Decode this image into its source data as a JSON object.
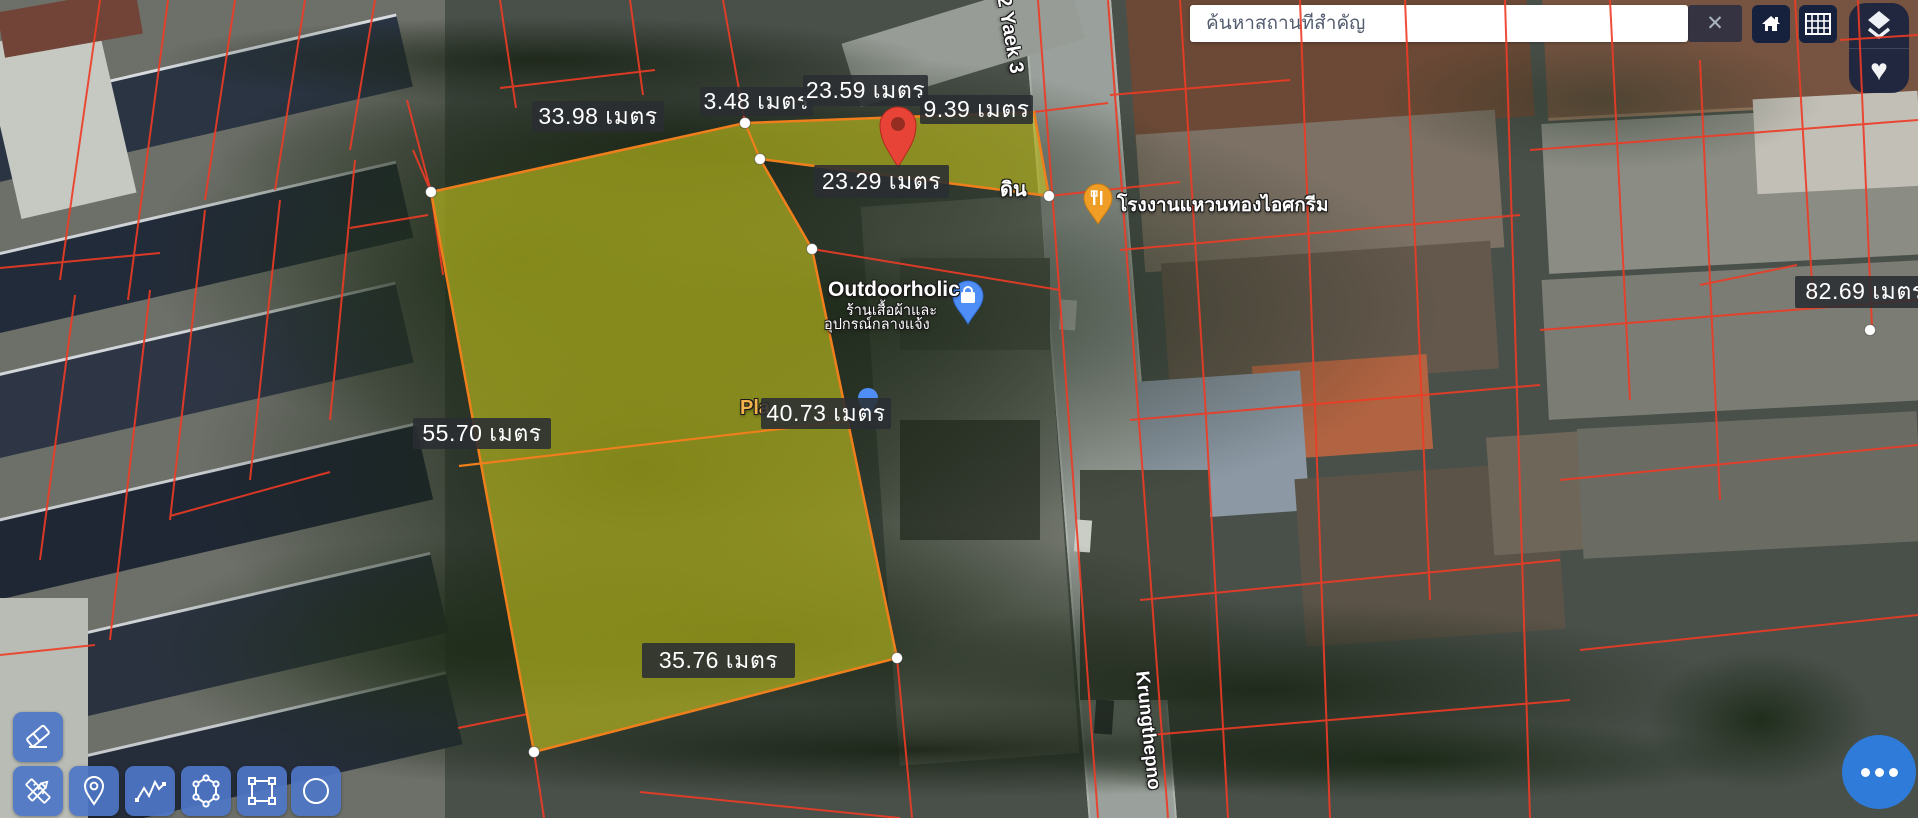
{
  "colors": {
    "parcel_fill": "#e2de1c",
    "parcel_border": "#ef7f1c",
    "cadastral_line": "#ee3b25",
    "tool_blue": "#4d76c7",
    "more_blue": "#2e7bd9",
    "marker_red": "#e74336"
  },
  "search": {
    "placeholder": "ค้นหาสถานที่สำคัญ"
  },
  "controls": {
    "close": "✕",
    "heart": "♥"
  },
  "measurements": [
    {
      "text": "33.98 เมตร",
      "x": 532,
      "y": 101,
      "w": 132,
      "h": 31
    },
    {
      "text": "3.48 เมตร",
      "x": 700,
      "y": 87,
      "w": 113,
      "h": 29
    },
    {
      "text": "23.59 เมตร",
      "x": 803,
      "y": 75,
      "w": 125,
      "h": 31
    },
    {
      "text": "9.39 เมตร",
      "x": 920,
      "y": 95,
      "w": 113,
      "h": 29
    },
    {
      "text": "23.29 เมตร",
      "x": 814,
      "y": 165,
      "w": 135,
      "h": 33
    },
    {
      "text": "55.70 เมตร",
      "x": 413,
      "y": 418,
      "w": 138,
      "h": 31
    },
    {
      "text": "40.73 เมตร",
      "x": 761,
      "y": 398,
      "w": 130,
      "h": 31
    },
    {
      "text": "35.76 เมตร",
      "x": 642,
      "y": 643,
      "w": 153,
      "h": 35
    },
    {
      "text": "82.69 เมตร",
      "x": 1795,
      "y": 276,
      "w": 140,
      "h": 32
    }
  ],
  "pois": {
    "outdoorholic": {
      "title": "Outdoorholic",
      "line1": "ร้านเสื้อผ้าและ",
      "line2": "อุปกรณ์กลางแจ้ง"
    },
    "factory": {
      "label": "โรงงานแหวนทองไอศกรีม"
    },
    "fragment_din": "ดิน",
    "fragment_pla": "Pla"
  },
  "roads": {
    "top": "2 Yaek 3",
    "right": "Krungthepno"
  },
  "tools": [
    "eraser",
    "measure-draw",
    "pin",
    "polyline",
    "polygon",
    "rectangle",
    "circle"
  ]
}
